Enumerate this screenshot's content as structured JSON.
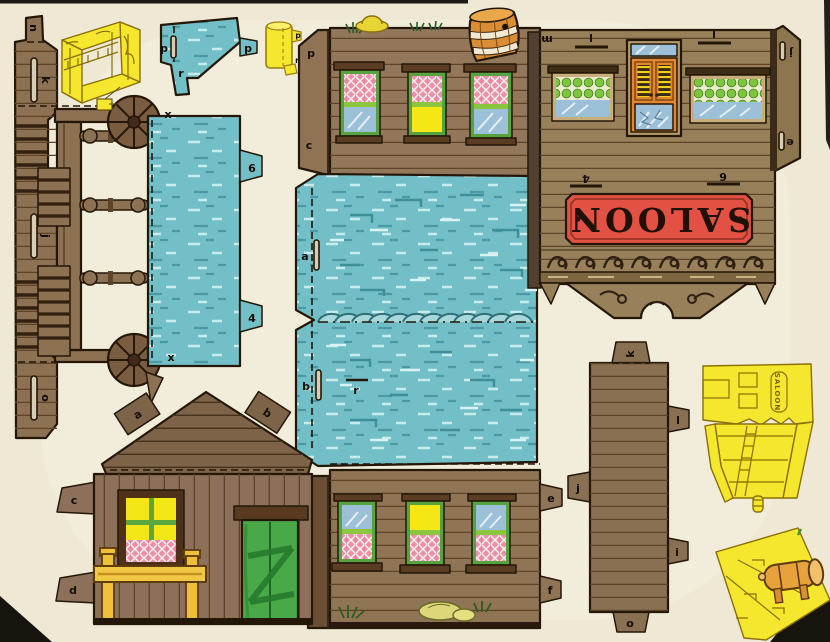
{
  "sheet": {
    "description": "vintage papercraft cut-out sheet of a western saloon building",
    "background_color": "#f2ecd9",
    "ink_color": "#241708"
  },
  "palette": {
    "wood": "#8e7354",
    "wood_dark": "#6b4f35",
    "wood_gold": "#97805a",
    "teal": "#72bfc7",
    "teal_dark": "#4b99a2",
    "teal_light": "#c8ecec",
    "yellow": "#f5e62e",
    "orange_door": "#e2872f",
    "barrel_orange": "#d98e33",
    "sign_red": "#e25144",
    "window_green": "#57a33f",
    "curtain_pink": "#ee8fa8",
    "glass_blue": "#9cc0d8",
    "lit_yellow": "#f5e616",
    "door_green": "#49a948",
    "rail_yellow": "#f0c845"
  },
  "labels": {
    "boardwalk": {
      "tab_top": "n",
      "slot_1": "k",
      "slot_2": "j",
      "slot_3": "o"
    },
    "porch": {
      "fold_top": "x",
      "fold_bottom": "x",
      "tab_upper": "6",
      "tab_lower": "4"
    },
    "gable": {
      "slot_left": "p",
      "tab_right": "p",
      "tab_bottom": "r"
    },
    "chimney": {
      "tab_side": "p",
      "tab_bottom": "r"
    },
    "wall_upper_flap": {
      "top": "p",
      "bottom": "c"
    },
    "saloon_front": {
      "corner": "m",
      "slot_top_left": "l",
      "slot_top_right": "l",
      "flap_slot_top": "j",
      "flap_slot_bottom": "e",
      "slot_bottom_left": "4",
      "slot_bottom_right": "6",
      "sign": "SALOON"
    },
    "roof": {
      "slot_a": "a",
      "slot_b": "b",
      "slot_r": "r"
    },
    "wall_lower": {
      "tab_top": "e",
      "tab_bottom": "f"
    },
    "house": {
      "tab_roof_left": "a",
      "tab_roof_right": "b",
      "tab_side_top": "c",
      "tab_side_bottom": "d"
    },
    "corner_strip": {
      "tab_top": "k",
      "tab_right_upper": "l",
      "tab_right_lower": "i",
      "tab_left": "j",
      "tab_bottom": "o"
    },
    "assembled_sketch": {
      "sign": "SALOON"
    }
  }
}
